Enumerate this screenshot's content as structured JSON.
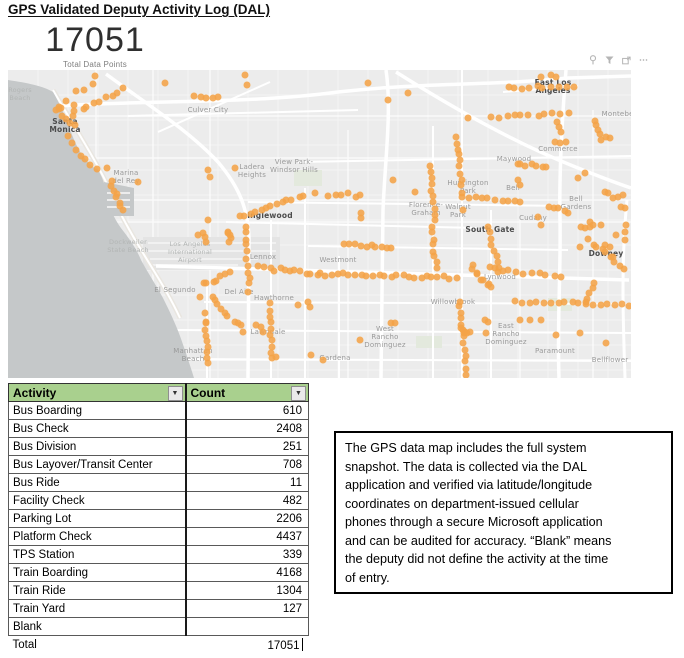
{
  "page_title": "GPS Validated Deputy Activity Log (DAL)",
  "card": {
    "value": "17051",
    "label": "Total Data Points"
  },
  "visual_header_icons": [
    "pin-icon",
    "filter-icon",
    "focus-mode-icon",
    "more-options-icon"
  ],
  "map": {
    "dot_color": "#F4A348",
    "labels": [
      {
        "name": "rogers-beach",
        "lines": [
          "Rogers",
          "Beach"
        ],
        "x": 12,
        "y": 24,
        "cls": "faint"
      },
      {
        "name": "santa-monica",
        "lines": [
          "Santa",
          "Monica"
        ],
        "x": 57,
        "y": 56,
        "cls": "major"
      },
      {
        "name": "culver-city",
        "lines": [
          "Culver City"
        ],
        "x": 200,
        "y": 40,
        "cls": "minor"
      },
      {
        "name": "marina-del-rey",
        "lines": [
          "Marina",
          "del Rey"
        ],
        "x": 118,
        "y": 107,
        "cls": "minor"
      },
      {
        "name": "ladera-heights",
        "lines": [
          "Ladera",
          "Heights"
        ],
        "x": 244,
        "y": 101,
        "cls": "minor"
      },
      {
        "name": "view-park-windsor-hills",
        "lines": [
          "View Park-",
          "Windsor Hills"
        ],
        "x": 286,
        "y": 96,
        "cls": "minor"
      },
      {
        "name": "inglewood",
        "lines": [
          "Inglewood"
        ],
        "x": 262,
        "y": 146,
        "cls": "major"
      },
      {
        "name": "east-los-angeles",
        "lines": [
          "East Los",
          "Angeles"
        ],
        "x": 545,
        "y": 17,
        "cls": "major"
      },
      {
        "name": "montebello",
        "lines": [
          "Montebello"
        ],
        "x": 614,
        "y": 44,
        "cls": "minor"
      },
      {
        "name": "commerce",
        "lines": [
          "Commerce"
        ],
        "x": 550,
        "y": 79,
        "cls": "minor"
      },
      {
        "name": "maywood",
        "lines": [
          "Maywood"
        ],
        "x": 506,
        "y": 89,
        "cls": "minor"
      },
      {
        "name": "huntington-park",
        "lines": [
          "Huntington",
          "Park"
        ],
        "x": 460,
        "y": 117,
        "cls": "minor"
      },
      {
        "name": "bell",
        "lines": [
          "Bell"
        ],
        "x": 505,
        "y": 118,
        "cls": "minor"
      },
      {
        "name": "florence-graham",
        "lines": [
          "Florence-",
          "Graham"
        ],
        "x": 418,
        "y": 139,
        "cls": "minor"
      },
      {
        "name": "walnut-park",
        "lines": [
          "Walnut",
          "Park"
        ],
        "x": 450,
        "y": 141,
        "cls": "minor"
      },
      {
        "name": "bell-gardens",
        "lines": [
          "Bell",
          "Gardens"
        ],
        "x": 568,
        "y": 133,
        "cls": "minor"
      },
      {
        "name": "cudahy",
        "lines": [
          "Cudahy"
        ],
        "x": 525,
        "y": 148,
        "cls": "minor"
      },
      {
        "name": "dockweiler-state-beach",
        "lines": [
          "Dockweiler",
          "State Beach"
        ],
        "x": 120,
        "y": 176,
        "cls": "faint"
      },
      {
        "name": "lax-airport",
        "lines": [
          "Los Angeles",
          "International",
          "Airport"
        ],
        "x": 182,
        "y": 182,
        "cls": "faint"
      },
      {
        "name": "lennox",
        "lines": [
          "Lennox"
        ],
        "x": 255,
        "y": 187,
        "cls": "minor"
      },
      {
        "name": "westmont",
        "lines": [
          "Westmont"
        ],
        "x": 330,
        "y": 190,
        "cls": "minor"
      },
      {
        "name": "el-segundo",
        "lines": [
          "El Segundo"
        ],
        "x": 167,
        "y": 220,
        "cls": "minor"
      },
      {
        "name": "del-aire",
        "lines": [
          "Del Aire"
        ],
        "x": 231,
        "y": 222,
        "cls": "minor"
      },
      {
        "name": "hawthorne",
        "lines": [
          "Hawthorne"
        ],
        "x": 266,
        "y": 228,
        "cls": "minor"
      },
      {
        "name": "lawndale",
        "lines": [
          "Lawndale"
        ],
        "x": 260,
        "y": 262,
        "cls": "minor"
      },
      {
        "name": "manhattan-beach",
        "lines": [
          "Manhattan",
          "Beach"
        ],
        "x": 185,
        "y": 285,
        "cls": "minor"
      },
      {
        "name": "gardena",
        "lines": [
          "Gardena"
        ],
        "x": 327,
        "y": 288,
        "cls": "minor"
      },
      {
        "name": "south-gate",
        "lines": [
          "South Gate"
        ],
        "x": 482,
        "y": 160,
        "cls": "major"
      },
      {
        "name": "downey",
        "lines": [
          "Downey"
        ],
        "x": 598,
        "y": 184,
        "cls": "major"
      },
      {
        "name": "lynwood",
        "lines": [
          "Lynwood"
        ],
        "x": 492,
        "y": 207,
        "cls": "minor"
      },
      {
        "name": "willowbrook",
        "lines": [
          "Willowbrook"
        ],
        "x": 445,
        "y": 232,
        "cls": "minor"
      },
      {
        "name": "west-rancho-dominguez",
        "lines": [
          "West",
          "Rancho",
          "Dominguez"
        ],
        "x": 377,
        "y": 267,
        "cls": "minor"
      },
      {
        "name": "east-rancho-dominguez",
        "lines": [
          "East",
          "Rancho",
          "Dominguez"
        ],
        "x": 498,
        "y": 264,
        "cls": "minor"
      },
      {
        "name": "paramount",
        "lines": [
          "Paramount"
        ],
        "x": 547,
        "y": 281,
        "cls": "minor"
      },
      {
        "name": "bellflower",
        "lines": [
          "Bellflower"
        ],
        "x": 602,
        "y": 290,
        "cls": "minor"
      }
    ],
    "segments": [
      [
        68,
        43,
        116,
        20,
        9,
        2
      ],
      [
        47,
        34,
        68,
        52,
        9,
        4
      ],
      [
        61,
        68,
        88,
        100,
        7,
        2
      ],
      [
        103,
        110,
        114,
        141,
        8,
        2
      ],
      [
        186,
        26,
        211,
        28,
        5,
        1
      ],
      [
        231,
        147,
        296,
        124,
        13,
        2
      ],
      [
        500,
        19,
        565,
        17,
        10,
        2
      ],
      [
        484,
        46,
        560,
        44,
        11,
        2
      ],
      [
        588,
        52,
        594,
        70,
        5,
        1.5
      ],
      [
        449,
        67,
        455,
        128,
        11,
        1.5
      ],
      [
        509,
        93,
        538,
        98,
        7,
        2
      ],
      [
        461,
        128,
        513,
        131,
        9,
        1.5
      ],
      [
        422,
        97,
        427,
        150,
        10,
        1
      ],
      [
        542,
        136,
        561,
        142,
        5,
        1.5
      ],
      [
        238,
        156,
        241,
        221,
        11,
        1.5
      ],
      [
        252,
        197,
        324,
        206,
        15,
        2
      ],
      [
        196,
        214,
        221,
        203,
        7,
        2.5
      ],
      [
        204,
        226,
        219,
        246,
        6,
        1.5
      ],
      [
        198,
        254,
        200,
        294,
        8,
        1
      ],
      [
        262,
        234,
        264,
        289,
        10,
        1
      ],
      [
        330,
        204,
        448,
        208,
        21,
        1.5
      ],
      [
        337,
        175,
        384,
        177,
        10,
        1.5
      ],
      [
        424,
        156,
        428,
        199,
        8,
        1.5
      ],
      [
        464,
        196,
        481,
        219,
        9,
        3
      ],
      [
        494,
        200,
        553,
        207,
        9,
        1.5
      ],
      [
        479,
        157,
        491,
        199,
        8,
        1.5
      ],
      [
        582,
        171,
        616,
        198,
        10,
        2.5
      ],
      [
        587,
        213,
        577,
        234,
        5,
        1
      ],
      [
        507,
        231,
        621,
        235,
        17,
        1.5
      ],
      [
        452,
        231,
        459,
        304,
        13,
        1.5
      ]
    ],
    "points": [
      [
        87,
        6
      ],
      [
        237,
        5
      ],
      [
        239,
        15
      ],
      [
        68,
        21
      ],
      [
        85,
        14
      ],
      [
        76,
        20
      ],
      [
        58,
        31
      ],
      [
        66,
        35
      ],
      [
        99,
        98
      ],
      [
        130,
        112
      ],
      [
        157,
        13
      ],
      [
        200,
        100
      ],
      [
        202,
        107
      ],
      [
        227,
        98
      ],
      [
        200,
        150
      ],
      [
        307,
        123
      ],
      [
        320,
        126
      ],
      [
        328,
        125
      ],
      [
        360,
        13
      ],
      [
        380,
        30
      ],
      [
        400,
        23
      ],
      [
        460,
        48
      ],
      [
        533,
        7
      ],
      [
        543,
        5
      ],
      [
        548,
        7
      ],
      [
        549,
        52
      ],
      [
        551,
        57
      ],
      [
        553,
        62
      ],
      [
        598,
        67
      ],
      [
        602,
        68
      ],
      [
        547,
        72
      ],
      [
        552,
        73
      ],
      [
        558,
        72
      ],
      [
        510,
        110
      ],
      [
        512,
        115
      ],
      [
        333,
        125
      ],
      [
        340,
        123
      ],
      [
        348,
        127
      ],
      [
        352,
        125
      ],
      [
        353,
        143
      ],
      [
        353,
        148
      ],
      [
        385,
        110
      ],
      [
        407,
        122
      ],
      [
        570,
        108
      ],
      [
        577,
        103
      ],
      [
        597,
        122
      ],
      [
        600,
        123
      ],
      [
        605,
        128
      ],
      [
        610,
        127
      ],
      [
        615,
        125
      ],
      [
        613,
        137
      ],
      [
        617,
        138
      ],
      [
        530,
        147
      ],
      [
        533,
        155
      ],
      [
        573,
        157
      ],
      [
        582,
        152
      ],
      [
        618,
        155
      ],
      [
        190,
        165
      ],
      [
        197,
        167
      ],
      [
        220,
        162
      ],
      [
        222,
        165
      ],
      [
        192,
        227
      ],
      [
        197,
        243
      ],
      [
        198,
        252
      ],
      [
        227,
        252
      ],
      [
        230,
        253
      ],
      [
        233,
        255
      ],
      [
        235,
        262
      ],
      [
        248,
        255
      ],
      [
        253,
        257
      ],
      [
        290,
        235
      ],
      [
        300,
        232
      ],
      [
        302,
        237
      ],
      [
        255,
        262
      ],
      [
        268,
        287
      ],
      [
        303,
        285
      ],
      [
        315,
        290
      ],
      [
        352,
        270
      ],
      [
        383,
        253
      ],
      [
        387,
        253
      ],
      [
        477,
        250
      ],
      [
        480,
        252
      ],
      [
        478,
        263
      ],
      [
        512,
        250
      ],
      [
        522,
        250
      ],
      [
        533,
        250
      ],
      [
        548,
        265
      ],
      [
        572,
        263
      ],
      [
        598,
        273
      ],
      [
        455,
        260
      ],
      [
        457,
        262
      ],
      [
        459,
        263
      ],
      [
        462,
        262
      ],
      [
        453,
        258
      ],
      [
        482,
        197
      ],
      [
        487,
        198
      ],
      [
        490,
        202
      ],
      [
        597,
        175
      ],
      [
        602,
        177
      ],
      [
        572,
        177
      ],
      [
        617,
        170
      ],
      [
        608,
        165
      ],
      [
        593,
        155
      ],
      [
        617,
        162
      ],
      [
        455,
        140
      ],
      [
        577,
        158
      ],
      [
        582,
        157
      ],
      [
        585,
        155
      ],
      [
        220,
        163
      ],
      [
        223,
        168
      ],
      [
        221,
        172
      ],
      [
        195,
        163
      ],
      [
        198,
        172
      ]
    ]
  },
  "table": {
    "headers": [
      "Activity",
      "Count"
    ],
    "rows": [
      [
        "Bus Boarding",
        "610"
      ],
      [
        "Bus Check",
        "2408"
      ],
      [
        "Bus Division",
        "251"
      ],
      [
        "Bus Layover/Transit Center",
        "708"
      ],
      [
        "Bus Ride",
        "11"
      ],
      [
        "Facility Check",
        "482"
      ],
      [
        "Parking Lot",
        "2206"
      ],
      [
        "Platform Check",
        "4437"
      ],
      [
        "TPS Station",
        "339"
      ],
      [
        "Train Boarding",
        "4168"
      ],
      [
        "Train Ride",
        "1304"
      ],
      [
        "Train Yard",
        "127"
      ],
      [
        "Blank",
        ""
      ],
      [
        "Total",
        "17051"
      ]
    ]
  },
  "note": {
    "lines": [
      "The GPS data map includes the full system",
      "snapshot. The data is collected via the DAL",
      "application and verified via latitude/longitude",
      "coordinates on department-issued cellular",
      "phones through a secure Microsoft application",
      "and can be audited for accuracy. “Blank” means",
      "the deputy did not define the activity at the time",
      "of entry."
    ]
  }
}
